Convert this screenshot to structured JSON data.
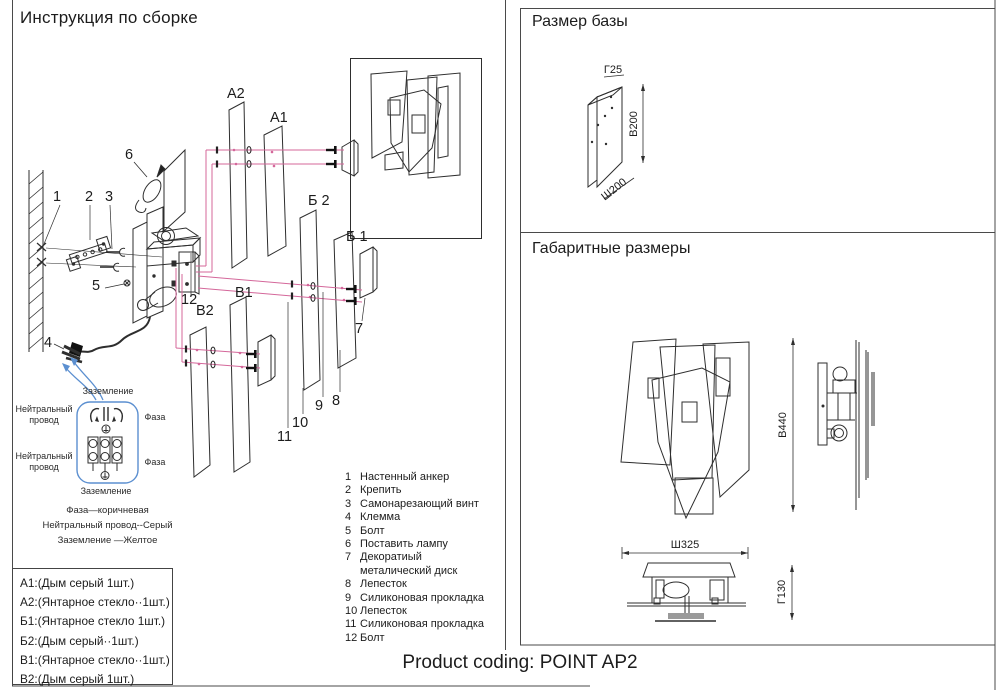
{
  "assembly": {
    "title": "Инструкция по сборке",
    "callouts": {
      "n1": "1",
      "n2": "2",
      "n3": "3",
      "n4": "4",
      "n5": "5",
      "n6": "6",
      "n7": "7",
      "n8": "8",
      "n9": "9",
      "n10": "10",
      "n11": "11",
      "n12": "12",
      "a2": "A2",
      "a1": "A1",
      "b2": "Б 2",
      "b1": "Б 1",
      "v1": "B1",
      "v2": "B2"
    },
    "wiring": {
      "ground_top": "Заземление",
      "neutral_top": "Нейтральный провод",
      "phase_top": "Фаза",
      "neutral_bottom": "Нейтральный провод",
      "phase_bottom": "Фаза",
      "ground_bottom": "Заземление",
      "legend": [
        "Фаза—коричневая",
        "Нейтральный провод--Серый",
        "Заземление —Желтое"
      ]
    },
    "parts": [
      {
        "num": "1",
        "label": "Настенный анкер"
      },
      {
        "num": "2",
        "label": "Крепить"
      },
      {
        "num": "3",
        "label": "Самонарезающий винт"
      },
      {
        "num": "4",
        "label": "Клемма"
      },
      {
        "num": "5",
        "label": "Болт"
      },
      {
        "num": "6",
        "label": "Поставить лампу"
      },
      {
        "num": "7",
        "label": "Декоратиый\nметалический диск"
      },
      {
        "num": "8",
        "label": "Лепесток"
      },
      {
        "num": "9",
        "label": "Силиконовая прокладка"
      },
      {
        "num": "10",
        "label": "Лепесток"
      },
      {
        "num": "11",
        "label": "Силиконовая прокладка"
      },
      {
        "num": "12",
        "label": "Болт"
      }
    ],
    "variants": [
      "A1:(Дым серый 1шт.)",
      "A2:(Янтарное стекло··1шт.)",
      "Б1:(Янтарное стекло 1шт.)",
      "Б2:(Дым серый··1шт.)",
      "B1:(Янтарное стекло··1шт.)",
      "B2:(Дым серый 1шт.)"
    ]
  },
  "base_size": {
    "title": "Размер базы",
    "dim_depth": "Г25",
    "dim_height": "В200",
    "dim_width": "Ш200"
  },
  "overall_size": {
    "title": "Габаритные размеры",
    "dim_height": "В440",
    "dim_width": "Ш325",
    "dim_depth": "Г130"
  },
  "footer": {
    "product_coding": "Product coding: POINT AP2"
  },
  "colors": {
    "line": "#2e2e2e",
    "pink": "#d4679a",
    "blue": "#5b8fd0"
  }
}
